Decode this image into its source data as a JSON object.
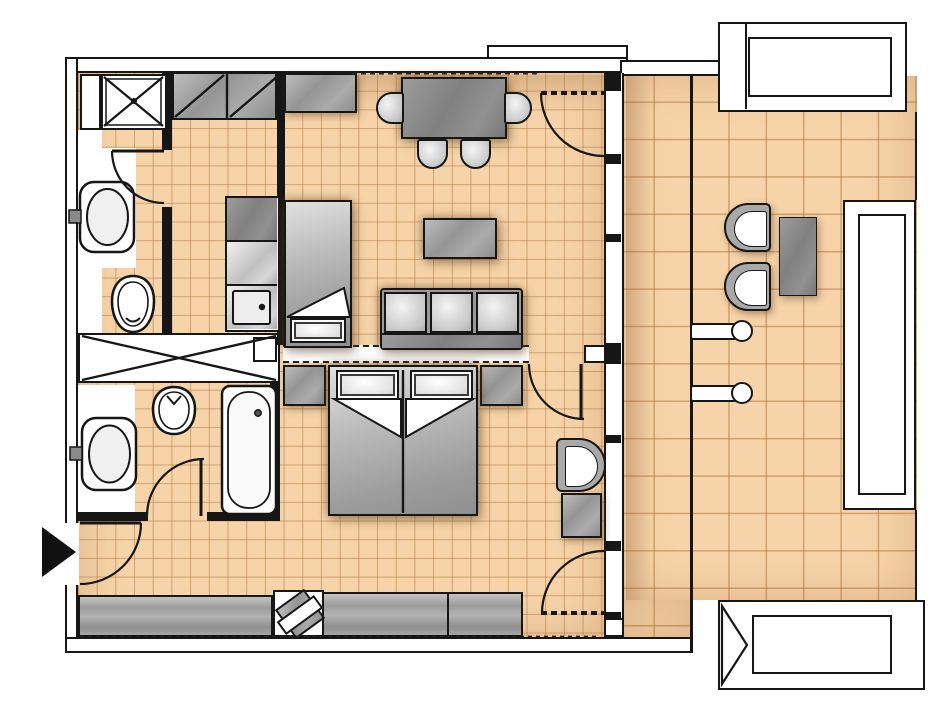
{
  "title": "Apartment floor plan with terrace",
  "colors": {
    "floor_tile": "#f6d3a8",
    "tile_line": "rgba(176,120,62,0.55)",
    "wall": "#161616",
    "wall_fill": "#ffffff",
    "furniture_gray": "#a2a2a2",
    "furniture_dark": "#8a8a8a",
    "fixture_white": "#ffffff",
    "background": "#ffffff"
  },
  "rooms": [
    {
      "id": "bathroom-top",
      "features": [
        "shower",
        "washbasin",
        "toilet",
        "vanity-strip",
        "door"
      ]
    },
    {
      "id": "kitchen",
      "features": [
        "tall-cabinet-row",
        "counter-with-cooktop",
        "kitchen-sink"
      ]
    },
    {
      "id": "living-dining-room",
      "features": [
        "sideboard",
        "daybed",
        "dining-table",
        "dining-chairs-x4",
        "coffee-table",
        "sofa-3-seat",
        "terrace-door"
      ]
    },
    {
      "id": "hallway",
      "features": [
        "entrance-door",
        "built-in-wardrobe-x",
        "sideboard"
      ]
    },
    {
      "id": "bathroom-bottom",
      "features": [
        "washbasin",
        "toilet",
        "bathtub",
        "door"
      ]
    },
    {
      "id": "bedroom",
      "features": [
        "double-bed",
        "nightstand-left",
        "nightstand-right",
        "armchair",
        "side-table",
        "desk",
        "desk-chair",
        "terrace-door"
      ]
    },
    {
      "id": "terrace",
      "features": [
        "lounge-chair-x2",
        "side-table",
        "wall-light-x2",
        "planter-top",
        "planter-right",
        "planter-bottom",
        "privacy-divider"
      ]
    }
  ],
  "symbols": {
    "entrance_marker": "solid black arrow pointing right at entry door",
    "wardrobe_marker": "crossed diagonals",
    "tall_cabinet_marker": "single diagonal"
  }
}
